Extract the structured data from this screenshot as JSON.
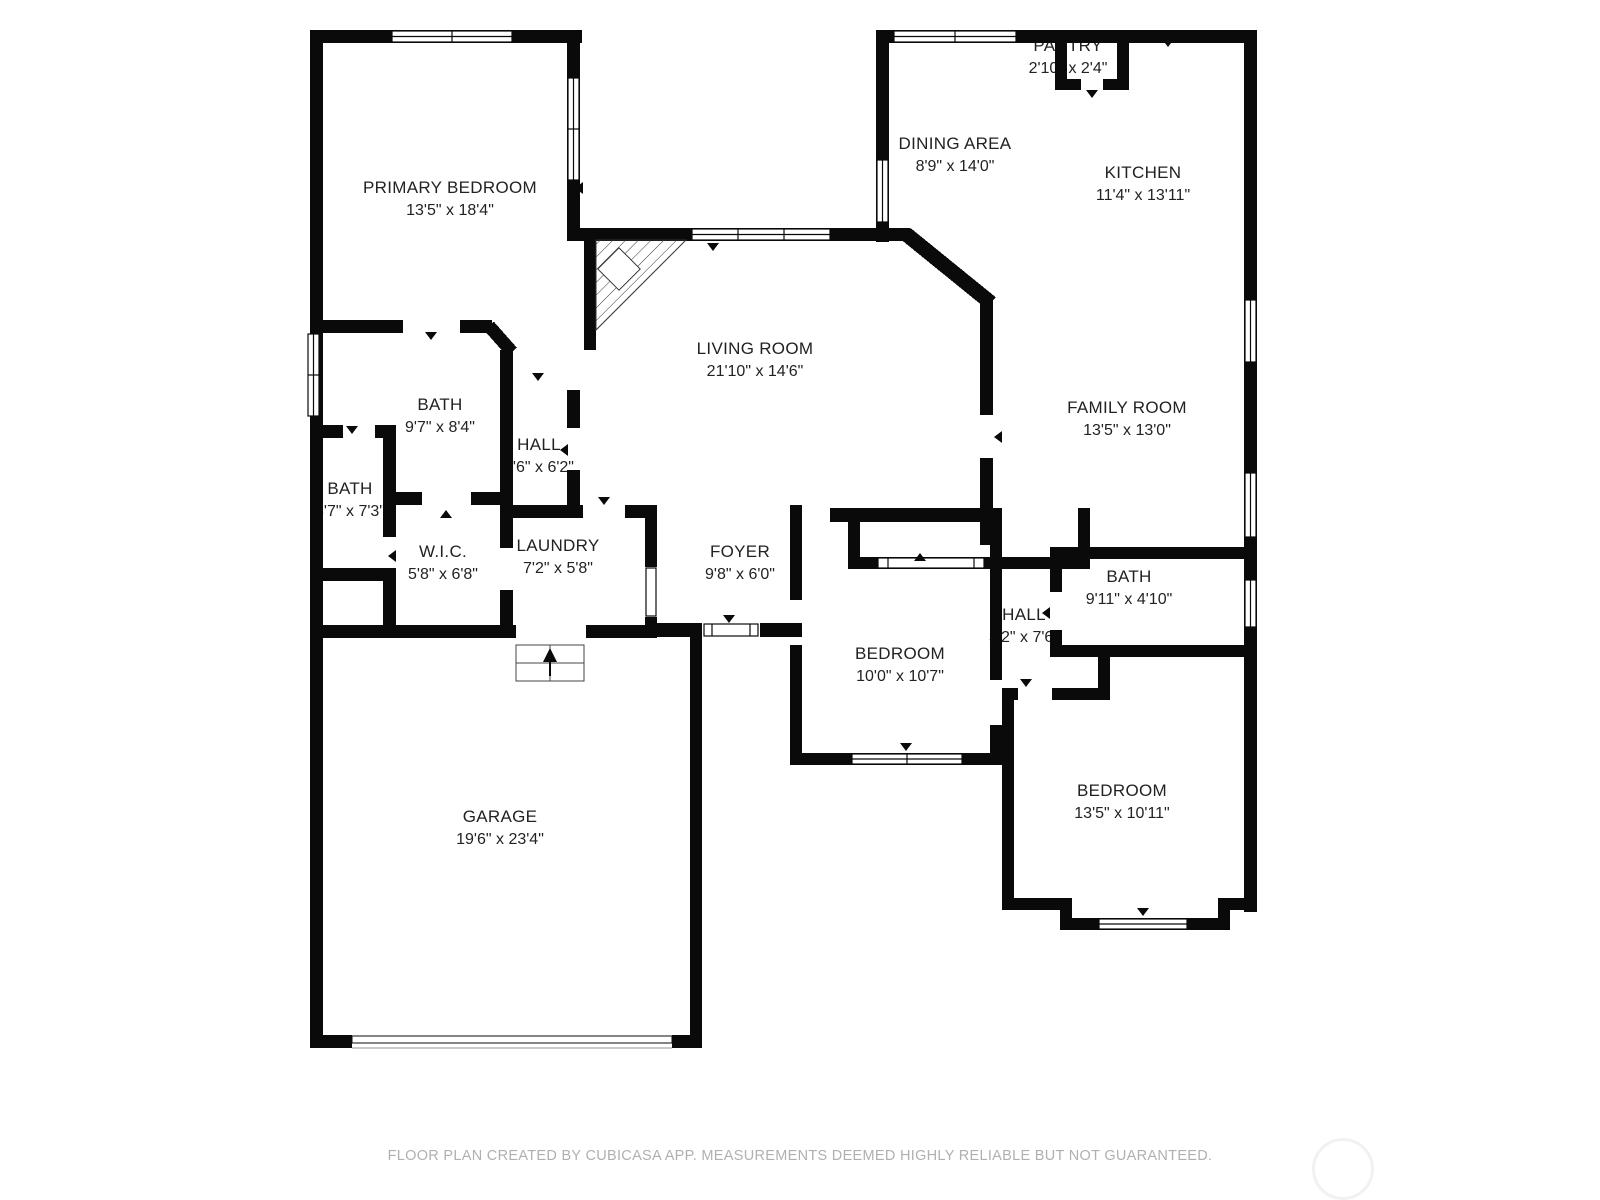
{
  "rooms": [
    {
      "name": "PRIMARY BEDROOM",
      "dims": "13'5\" x 18'4\""
    },
    {
      "name": "PANTRY",
      "dims": "2'10\" x 2'4\""
    },
    {
      "name": "DINING AREA",
      "dims": "8'9\" x 14'0\""
    },
    {
      "name": "KITCHEN",
      "dims": "11'4\" x 13'11\""
    },
    {
      "name": "LIVING ROOM",
      "dims": "21'10\" x 14'6\""
    },
    {
      "name": "FAMILY ROOM",
      "dims": "13'5\" x 13'0\""
    },
    {
      "name": "BATH",
      "dims": "9'7\" x 8'4\""
    },
    {
      "name": "HALL",
      "dims": "3'6\" x 6'2\""
    },
    {
      "name": "BATH",
      "dims": "3'7\" x 7'3\""
    },
    {
      "name": "W.I.C.",
      "dims": "5'8\" x 6'8\""
    },
    {
      "name": "LAUNDRY",
      "dims": "7'2\" x 5'8\""
    },
    {
      "name": "FOYER",
      "dims": "9'8\" x 6'0\""
    },
    {
      "name": "BEDROOM",
      "dims": "10'0\" x 10'7\""
    },
    {
      "name": "HALL",
      "dims": "3'2\" x 7'6\""
    },
    {
      "name": "BATH",
      "dims": "9'11\" x 4'10\""
    },
    {
      "name": "BEDROOM",
      "dims": "13'5\" x 10'11\""
    },
    {
      "name": "GARAGE",
      "dims": "19'6\" x 23'4\""
    }
  ],
  "footer": {
    "disclaimer": "FLOOR PLAN CREATED BY CUBICASA APP. MEASUREMENTS DEEMED HIGHLY RELIABLE BUT NOT GUARANTEED."
  },
  "colors": {
    "wall": "#0a0a0a",
    "label_text": "#222222",
    "footer_text": "#b0b0b0",
    "background": "#ffffff"
  }
}
